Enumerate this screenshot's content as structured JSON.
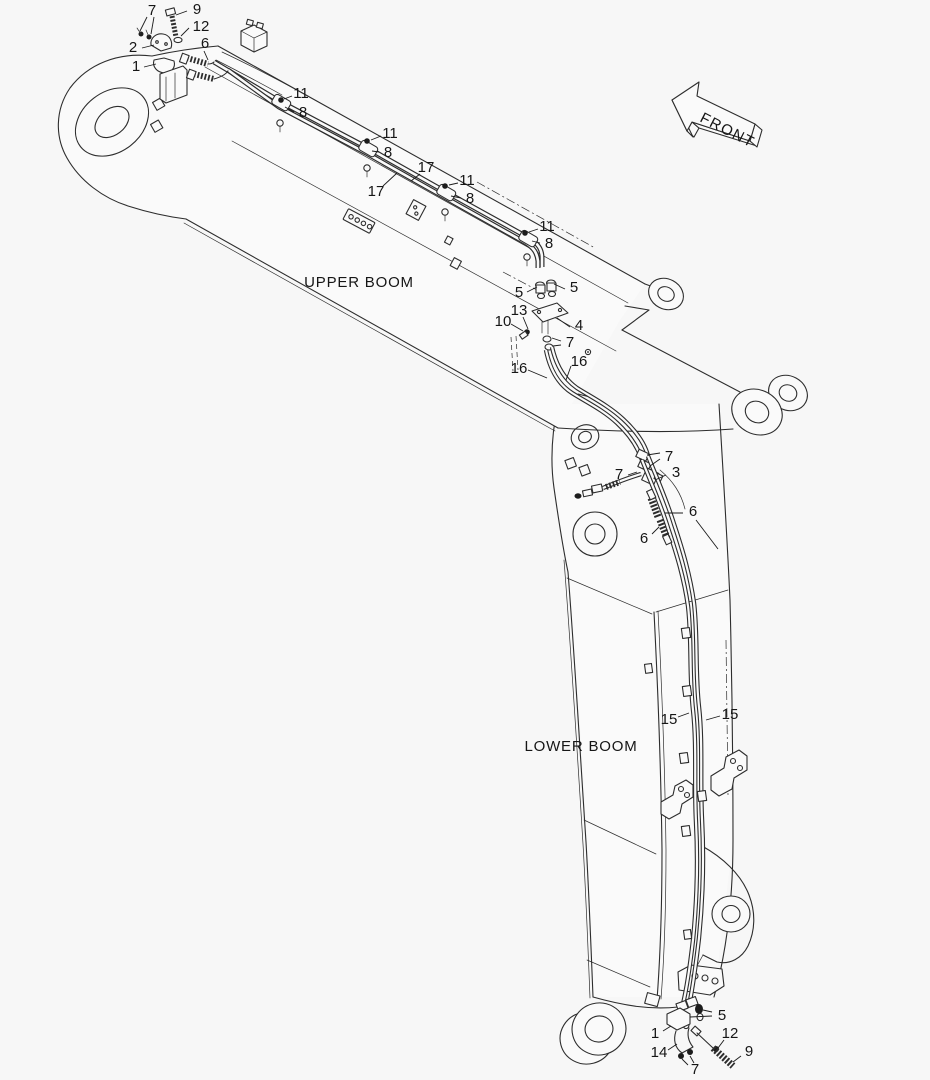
{
  "meta": {
    "background": "#f7f7f7",
    "line_color": "#2d2d2d",
    "text_color": "#161616"
  },
  "labels": {
    "upper_boom": "UPPER BOOM",
    "lower_boom": "LOWER BOOM",
    "front": "FRONT"
  },
  "callouts": [
    {
      "label": "7",
      "x": 152,
      "y": 15,
      "leaders": [
        [
          147,
          17,
          140,
          31
        ],
        [
          154,
          17,
          151,
          34
        ]
      ]
    },
    {
      "label": "9",
      "x": 197,
      "y": 14,
      "leaders": [
        [
          187,
          11,
          176,
          15
        ]
      ]
    },
    {
      "label": "12",
      "x": 201,
      "y": 31,
      "leaders": [
        [
          189,
          28,
          181,
          36
        ]
      ]
    },
    {
      "label": "2",
      "x": 133,
      "y": 52,
      "leaders": [
        [
          142,
          48,
          154,
          45
        ]
      ]
    },
    {
      "label": "6",
      "x": 205,
      "y": 48,
      "leaders": [
        [
          204,
          51,
          208,
          60
        ]
      ]
    },
    {
      "label": "1",
      "x": 136,
      "y": 71,
      "leaders": [
        [
          144,
          67,
          156,
          64
        ]
      ]
    },
    {
      "label": "11",
      "x": 301,
      "y": 98,
      "dot": [
        281,
        100
      ],
      "leaders": [
        [
          292,
          96,
          284,
          99
        ]
      ]
    },
    {
      "label": "8",
      "x": 303,
      "y": 117,
      "leaders": [
        [
          294,
          112,
          285,
          107
        ]
      ]
    },
    {
      "label": "11",
      "x": 390,
      "y": 138,
      "dot": [
        367,
        141
      ],
      "leaders": [
        [
          381,
          136,
          371,
          140
        ]
      ]
    },
    {
      "label": "8",
      "x": 388,
      "y": 157,
      "leaders": [
        [
          379,
          152,
          372,
          151
        ]
      ]
    },
    {
      "label": "17",
      "x": 376,
      "y": 196,
      "leaders": [
        [
          383,
          186,
          397,
          173
        ]
      ]
    },
    {
      "label": "17",
      "x": 426,
      "y": 172,
      "leaders": [
        [
          420,
          174,
          411,
          181
        ]
      ]
    },
    {
      "label": "11",
      "x": 467,
      "y": 185,
      "dot": [
        445,
        186
      ],
      "leaders": [
        [
          458,
          183,
          449,
          185
        ]
      ]
    },
    {
      "label": "8",
      "x": 470,
      "y": 203,
      "leaders": [
        [
          461,
          198,
          451,
          196
        ]
      ]
    },
    {
      "label": "11",
      "x": 547,
      "y": 231,
      "dot": [
        525,
        233
      ],
      "leaders": [
        [
          538,
          229,
          529,
          232
        ]
      ]
    },
    {
      "label": "8",
      "x": 549,
      "y": 248,
      "leaders": [
        [
          540,
          243,
          532,
          241
        ]
      ]
    },
    {
      "label": "5",
      "x": 519,
      "y": 297,
      "leaders": [
        [
          527,
          292,
          537,
          287
        ]
      ]
    },
    {
      "label": "5",
      "x": 574,
      "y": 292,
      "leaders": [
        [
          565,
          289,
          554,
          284
        ]
      ]
    },
    {
      "label": "13",
      "x": 519,
      "y": 315,
      "leaders": [
        [
          523,
          317,
          528,
          329
        ]
      ]
    },
    {
      "label": "10",
      "x": 503,
      "y": 326,
      "leaders": [
        [
          511,
          324,
          523,
          331
        ]
      ]
    },
    {
      "label": "4",
      "x": 579,
      "y": 330,
      "leaders": [
        [
          570,
          327,
          557,
          318
        ]
      ]
    },
    {
      "label": "7",
      "x": 570,
      "y": 347,
      "leaders": [
        [
          561,
          341,
          552,
          338
        ],
        [
          561,
          345,
          553,
          346
        ]
      ]
    },
    {
      "label": "16",
      "x": 519,
      "y": 373,
      "leaders": [
        [
          528,
          370,
          547,
          378
        ]
      ]
    },
    {
      "label": "16",
      "x": 579,
      "y": 366,
      "leaders": [
        [
          571,
          366,
          566,
          380
        ]
      ]
    },
    {
      "label": "7",
      "x": 669,
      "y": 461,
      "leaders": [
        [
          660,
          453,
          647,
          455
        ],
        [
          660,
          459,
          650,
          466
        ]
      ]
    },
    {
      "label": "7",
      "x": 619,
      "y": 479,
      "leaders": [
        [
          628,
          475,
          637,
          472
        ]
      ]
    },
    {
      "label": "3",
      "x": 676,
      "y": 477,
      "leaders": [
        [
          666,
          475,
          655,
          480
        ]
      ]
    },
    {
      "label": "6",
      "x": 693,
      "y": 516,
      "leaders": [
        [
          683,
          513,
          665,
          513
        ],
        [
          696,
          520,
          718,
          549
        ]
      ]
    },
    {
      "label": "6",
      "x": 644,
      "y": 543,
      "leaders": [
        [
          652,
          534,
          659,
          527
        ]
      ]
    },
    {
      "label": "15",
      "x": 669,
      "y": 724,
      "leaders": [
        [
          678,
          717,
          689,
          713
        ]
      ]
    },
    {
      "label": "15",
      "x": 730,
      "y": 719,
      "leaders": [
        [
          720,
          716,
          706,
          720
        ]
      ]
    },
    {
      "label": "5",
      "x": 722,
      "y": 1020,
      "leaders": [
        [
          712,
          1012,
          703,
          1010
        ],
        [
          712,
          1016,
          690,
          1017
        ]
      ]
    },
    {
      "label": "1",
      "x": 655,
      "y": 1038,
      "leaders": [
        [
          663,
          1031,
          671,
          1026
        ]
      ]
    },
    {
      "label": "12",
      "x": 730,
      "y": 1038,
      "leaders": [
        [
          724,
          1040,
          718,
          1048
        ]
      ]
    },
    {
      "label": "14",
      "x": 659,
      "y": 1057,
      "leaders": [
        [
          668,
          1050,
          677,
          1044
        ]
      ]
    },
    {
      "label": "9",
      "x": 749,
      "y": 1056,
      "leaders": [
        [
          741,
          1056,
          733,
          1062
        ]
      ]
    },
    {
      "label": "7",
      "x": 695,
      "y": 1074,
      "leaders": [
        [
          688,
          1065,
          682,
          1059
        ],
        [
          694,
          1063,
          690,
          1056
        ]
      ]
    }
  ]
}
